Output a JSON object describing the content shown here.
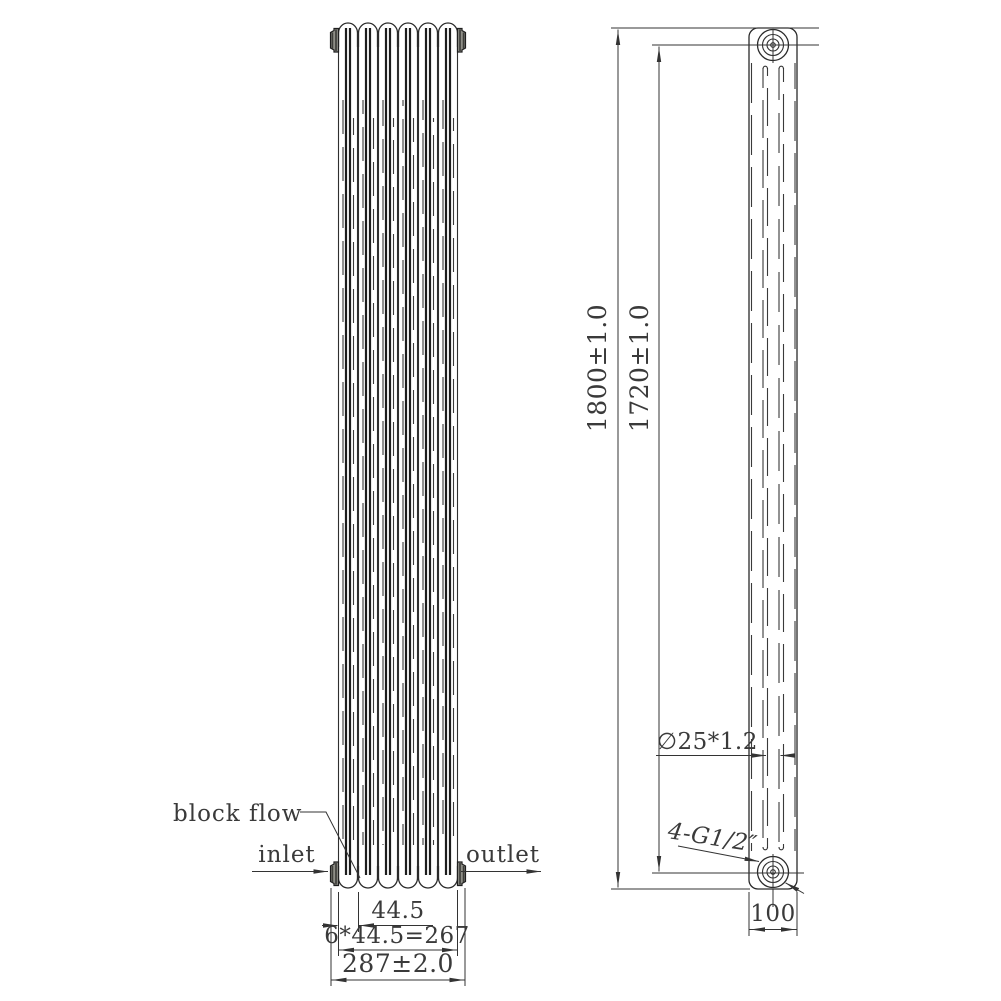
{
  "drawing": {
    "type": "technical-drawing",
    "subject": "3-column vertical radiator, front and side orthographic views",
    "colors": {
      "background": "#ffffff",
      "line": "#2a2a2a",
      "text": "#3a3a3a",
      "cap_fill": "#8f8f88"
    },
    "labels": {
      "block_flow": "block flow",
      "inlet": "inlet",
      "outlet": "outlet"
    },
    "dimensions": {
      "section_pitch": "44.5",
      "sections_total": "6*44.5=267",
      "overall_width": "287±2.0",
      "overall_height": "1800±1.0",
      "port_distance": "1720±1.0",
      "tube_spec": "∅25*1.2",
      "thread_spec": "4-G1/2″",
      "depth": "100"
    }
  }
}
